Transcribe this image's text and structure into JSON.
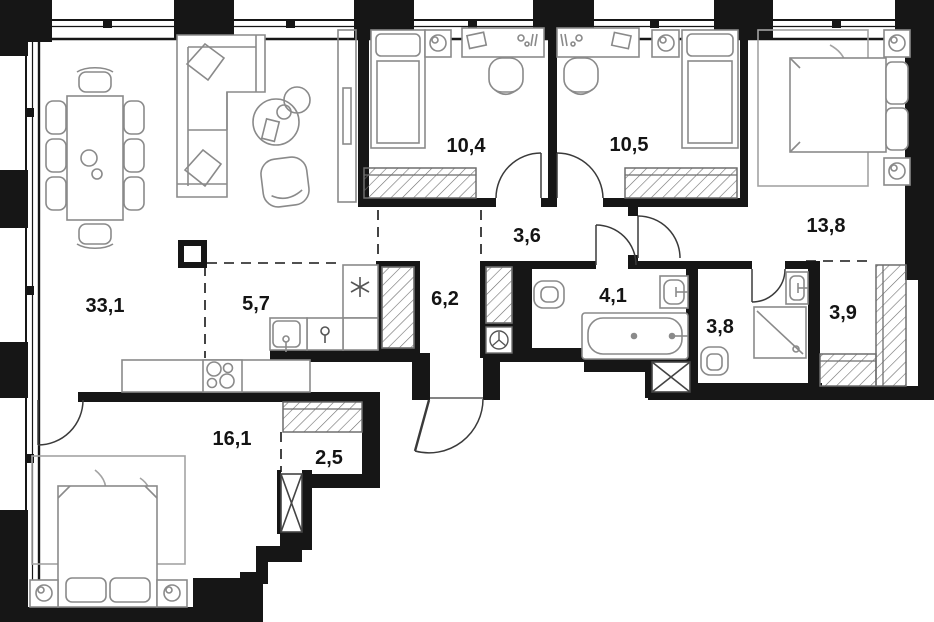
{
  "plan": {
    "title": "Apartment floor plan",
    "colors": {
      "wall": "#161616",
      "furniture_stroke": "#8a8a8a",
      "hatch_stroke": "#6e6e6e",
      "carpet_stroke": "#a3a3a3",
      "label_color": "#141414",
      "floor": "#ffffff"
    },
    "rooms": {
      "living": {
        "label": "33,1",
        "name": "living-dining room"
      },
      "kitchen": {
        "label": "5,7",
        "name": "kitchen zone"
      },
      "corridor": {
        "label": "6,2",
        "name": "entry corridor"
      },
      "hall": {
        "label": "3,6",
        "name": "inner hall"
      },
      "bedroom1": {
        "label": "10,4",
        "name": "bedroom 1"
      },
      "bedroom2": {
        "label": "10,5",
        "name": "bedroom 2"
      },
      "master": {
        "label": "13,8",
        "name": "master bedroom"
      },
      "bathroom": {
        "label": "4,1",
        "name": "bathroom"
      },
      "shower": {
        "label": "3,8",
        "name": "shower room"
      },
      "wardrobe": {
        "label": "3,9",
        "name": "walk-in wardrobe"
      },
      "bedroom3": {
        "label": "16,1",
        "name": "bedroom 3"
      },
      "closet": {
        "label": "2,5",
        "name": "closet"
      }
    },
    "furniture": [
      "dining-table-8-chairs",
      "corner-sofa",
      "coffee-tables",
      "armchair",
      "tv-console",
      "fridge",
      "kitchen-sink",
      "stove-4-burners",
      "kitchen-counter",
      "single-bed-2x",
      "nightstand-lamp-5x",
      "desk-2x",
      "desk-chair-2x",
      "double-bed-2x",
      "carpet-2x",
      "bathtub",
      "washbasin-2x",
      "toilet-2x",
      "shower-cabin",
      "wardrobe-hatch-6x",
      "vent-shaft-2x",
      "structural-column",
      "water-manifold"
    ]
  }
}
